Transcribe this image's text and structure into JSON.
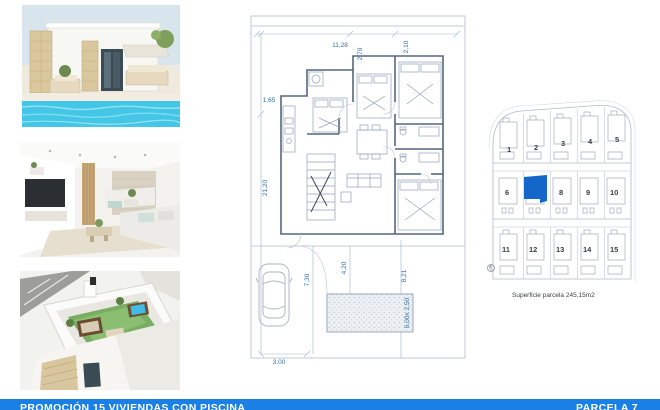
{
  "brochure": {
    "footer": {
      "left": "PROMOCIÓN 15 VIVIENDAS CON PISCINA",
      "right": "PARCELA 7",
      "bg_color": "#1a80e6",
      "text_color": "#ffffff"
    },
    "photos": [
      {
        "name": "villa-pool-exterior",
        "description": "white villa with stone pillars, terrace sofas and turquoise pool"
      },
      {
        "name": "living-room-interior",
        "description": "bright living room render with TV wall and beige sofas"
      },
      {
        "name": "rooftop-terrace",
        "description": "aerial render of rooftop solarium with lawn, lounge set and jacuzzi"
      }
    ],
    "floorplan": {
      "dim_color": "#2f6fae",
      "dim_total_width": "11,28",
      "dim_top_inner": "2,70",
      "dim_top_right": "2,10",
      "dim_left_small": "1,65",
      "dim_total_length": "21,20",
      "dim_yard_left": "7,30",
      "dim_yard_mid": "4,20",
      "dim_yard_right": "8,21",
      "dim_pool": "6,00x 2,50",
      "dim_bottom": "3,00"
    },
    "siteplan": {
      "caption": "Superficie parcela 245,15m2",
      "highlighted_plot": "7",
      "highlight_color": "#1467c9",
      "plots": [
        {
          "label": "1"
        },
        {
          "label": "2"
        },
        {
          "label": "3"
        },
        {
          "label": "4"
        },
        {
          "label": "5"
        },
        {
          "label": "6"
        },
        {
          "label": "7"
        },
        {
          "label": "8"
        },
        {
          "label": "9"
        },
        {
          "label": "10"
        },
        {
          "label": "11"
        },
        {
          "label": "12"
        },
        {
          "label": "13"
        },
        {
          "label": "14"
        },
        {
          "label": "15"
        }
      ]
    }
  }
}
